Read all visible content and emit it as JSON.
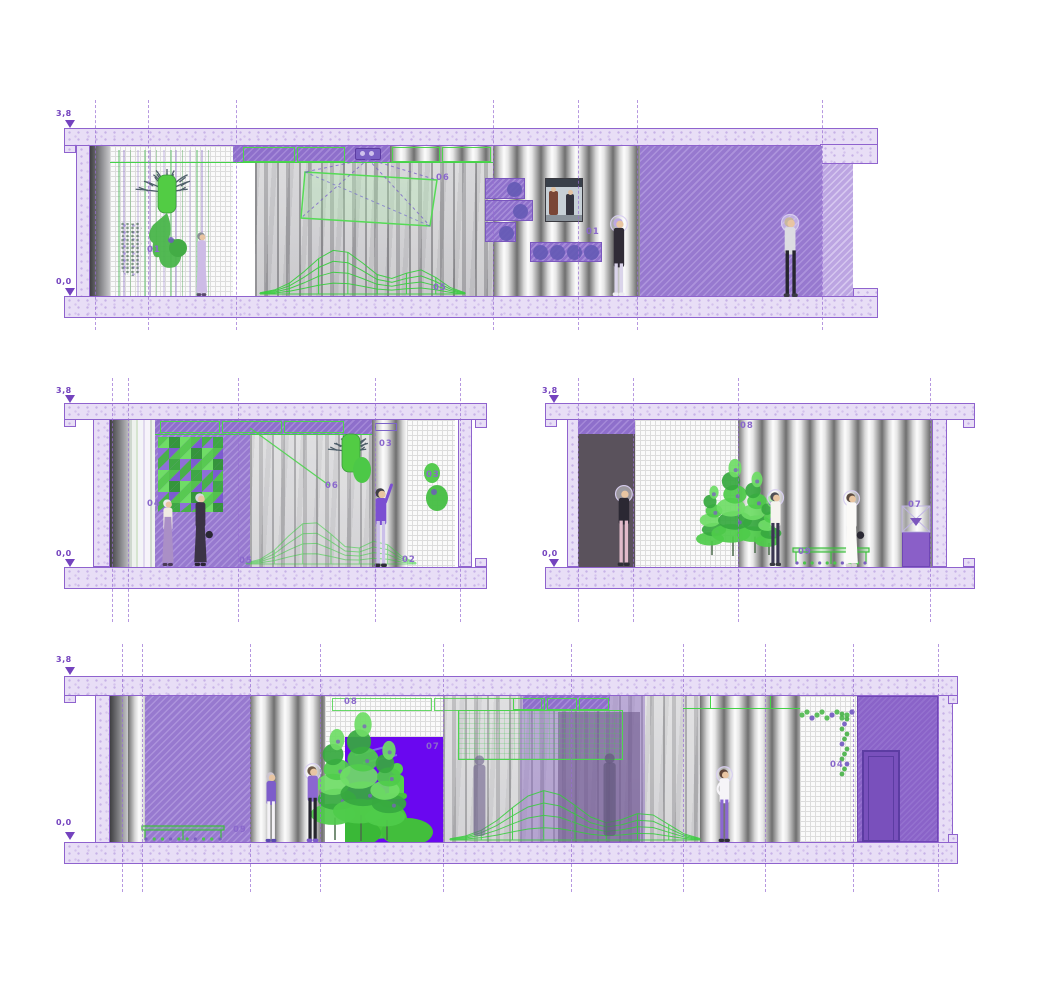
{
  "drawing": {
    "type": "architectural-sections",
    "colors": {
      "accent_purple": "#8F63CE",
      "wall_purple": "#9779CF",
      "slab_lilac": "#E8DEF6",
      "green_accent": "#44D348",
      "callout_text": "#8A68CC",
      "level_text": "#7443BE"
    }
  },
  "sections": [
    {
      "name": "long-section-upper",
      "elevation_upper": "3,8",
      "elevation_lower": "0,0"
    },
    {
      "name": "cross-section-left",
      "elevation_upper": "3,8",
      "elevation_lower": "0,0"
    },
    {
      "name": "cross-section-right",
      "elevation_upper": "3,8",
      "elevation_lower": "0,0"
    },
    {
      "name": "long-section-lower",
      "elevation_upper": "3,8",
      "elevation_lower": "0,0"
    }
  ],
  "callouts": [
    {
      "section": "long-section-upper",
      "text": "01",
      "x": 147,
      "y": 245
    },
    {
      "section": "long-section-upper",
      "text": "06",
      "x": 436,
      "y": 173
    },
    {
      "section": "long-section-upper",
      "text": "05",
      "x": 433,
      "y": 283
    },
    {
      "section": "long-section-upper",
      "text": "01",
      "x": 586,
      "y": 227
    },
    {
      "section": "cross-section-left",
      "text": "04",
      "x": 147,
      "y": 499
    },
    {
      "section": "cross-section-left",
      "text": "05",
      "x": 239,
      "y": 556
    },
    {
      "section": "cross-section-left",
      "text": "06",
      "x": 325,
      "y": 481
    },
    {
      "section": "cross-section-left",
      "text": "03",
      "x": 379,
      "y": 439
    },
    {
      "section": "cross-section-left",
      "text": "03",
      "x": 426,
      "y": 470
    },
    {
      "section": "cross-section-left",
      "text": "02",
      "x": 402,
      "y": 555
    },
    {
      "section": "cross-section-right",
      "text": "08",
      "x": 740,
      "y": 421
    },
    {
      "section": "cross-section-right",
      "text": "09",
      "x": 798,
      "y": 547
    },
    {
      "section": "cross-section-right",
      "text": "07",
      "x": 908,
      "y": 500
    },
    {
      "section": "long-section-lower",
      "text": "09",
      "x": 233,
      "y": 825
    },
    {
      "section": "long-section-lower",
      "text": "08",
      "x": 344,
      "y": 697
    },
    {
      "section": "long-section-lower",
      "text": "07",
      "x": 426,
      "y": 742
    },
    {
      "section": "long-section-lower",
      "text": "04",
      "x": 830,
      "y": 760
    }
  ]
}
